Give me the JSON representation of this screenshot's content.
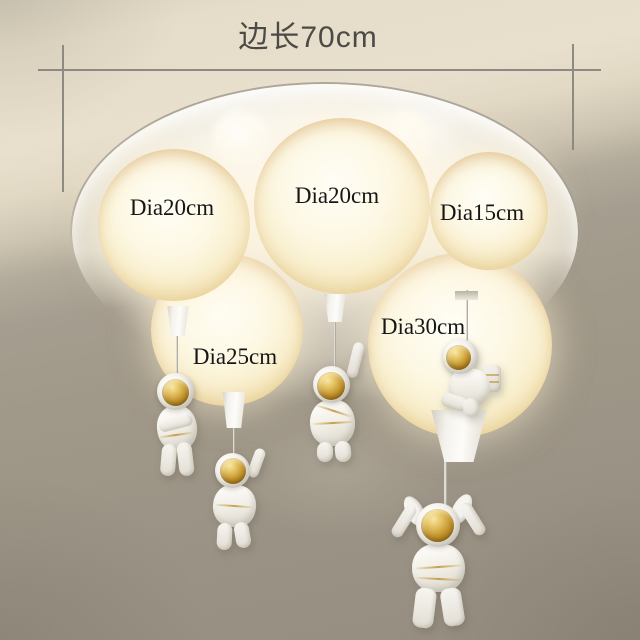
{
  "product": {
    "description": "flush-mount ceiling lamp with glowing balloon shades and hanging astronaut figurines",
    "astronaut_count": 5,
    "astronaut_poses": [
      "standing",
      "waving-arm-raised",
      "arm-raised-high",
      "climbing-profile",
      "both-arms-up-bunny-ears"
    ]
  },
  "dimension": {
    "label": "边长70cm",
    "edge_length_cm": 70
  },
  "balloons": [
    {
      "id": "left",
      "label": "Dia20cm",
      "diameter_cm": 20
    },
    {
      "id": "center",
      "label": "Dia20cm",
      "diameter_cm": 20
    },
    {
      "id": "right",
      "label": "Dia15cm",
      "diameter_cm": 15
    },
    {
      "id": "bottom-left",
      "label": "Dia25cm",
      "diameter_cm": 25
    },
    {
      "id": "bottom-right",
      "label": "Dia30cm",
      "diameter_cm": 30
    }
  ],
  "colors": {
    "ceiling_beige": "#e8e0cd",
    "wall_gray": "#a09888",
    "plate_white": "#faf7f0",
    "balloon_cream": "#fdf8e4",
    "balloon_edge_amber": "#ecd79b",
    "gold_visor": "#c2922c",
    "suit_white": "#f2efe9",
    "label_text": "#161616",
    "dimension_text": "#4b4a46",
    "dimension_line": "#8c8a83"
  }
}
